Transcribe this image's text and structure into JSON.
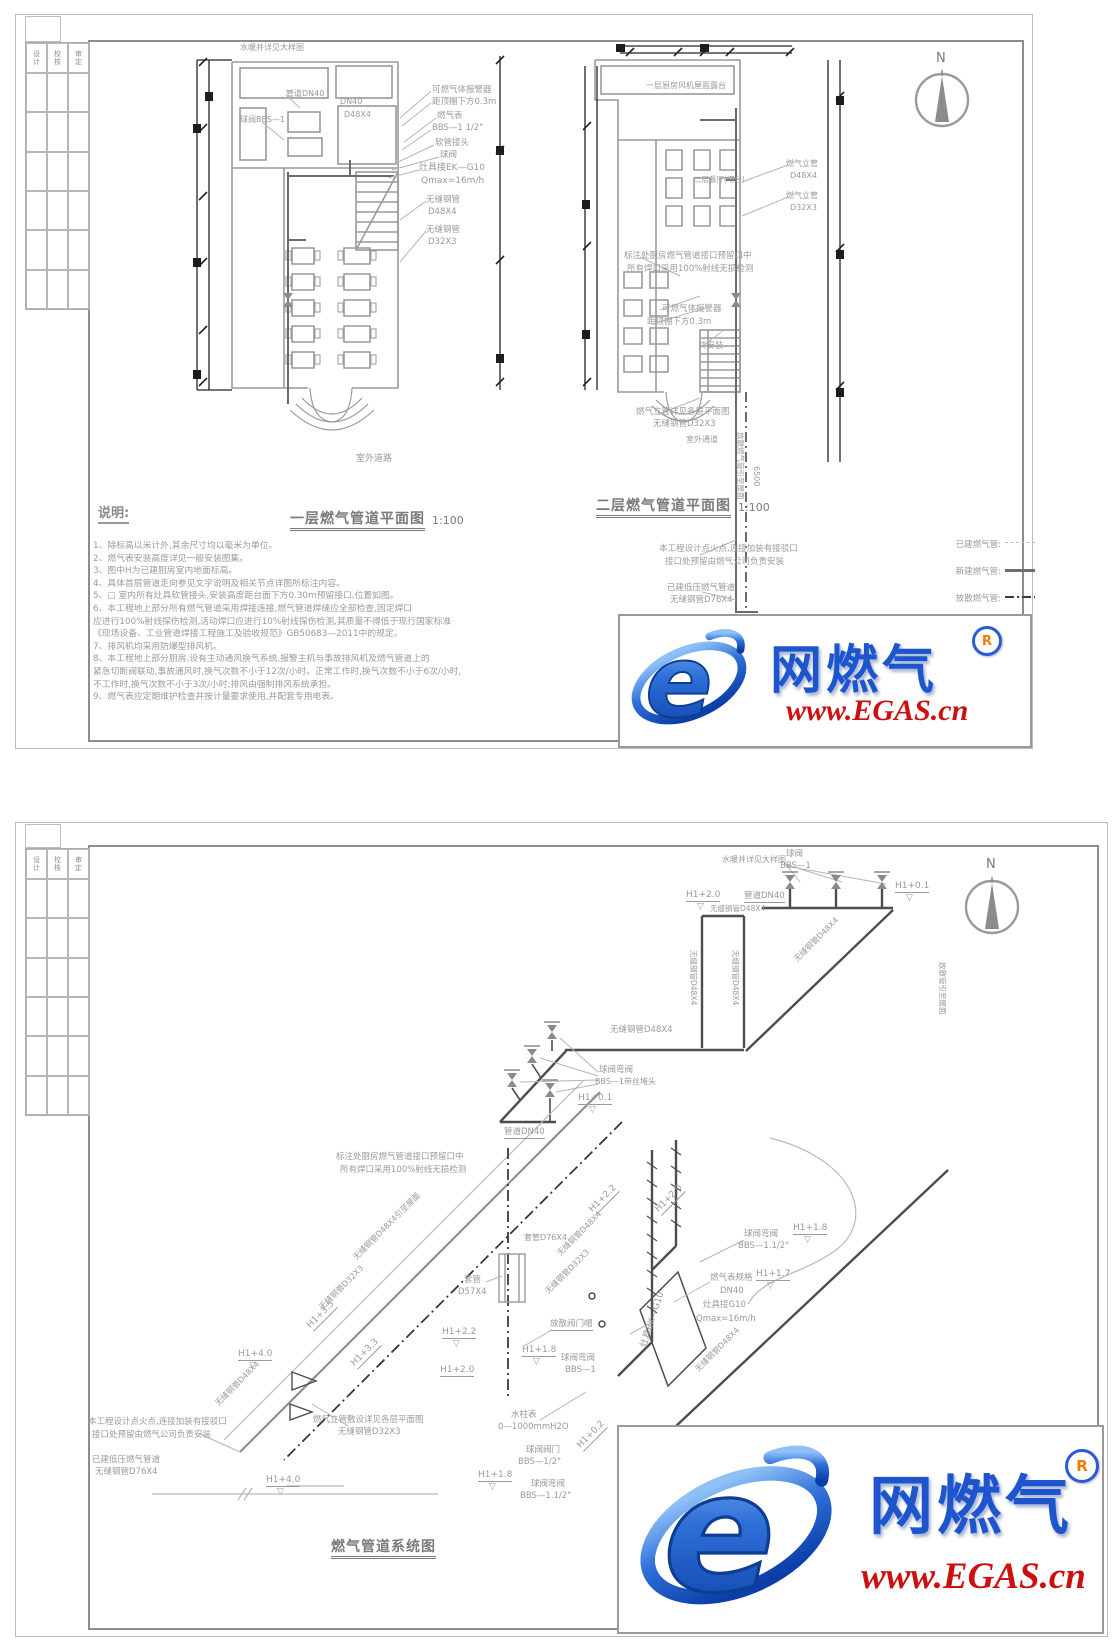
{
  "titleblock": {
    "headers": [
      "设计",
      "校核",
      "审定"
    ]
  },
  "watermark": {
    "brand": "网燃气",
    "reg": "R",
    "url": "www.EGAS.cn"
  },
  "sheet1": {
    "notes_heading": "说明:",
    "notes": [
      "1、除标高以米计外,其余尺寸均以毫米为单位。",
      "2、燃气表安装高度详见一般安装图集。",
      "3、图中H为已建厨房室内地面标高。",
      "4、具体首层管道走向参见文字说明及相关节点详图所标注内容。",
      "5、□  室内所有灶具软管接头,安装高度距台面下方0.30m预留接口,位置如图。",
      "6、本工程地上部分所有燃气管道采用焊接连接,燃气管道焊缝应全部检查,固定焊口",
      "应进行100%射线探伤检测,活动焊口应进行10%射线探伤检测,其质量不得低于现行国家标准",
      "《现场设备、工业管道焊接工程施工及验收规范》GB50683—2011中的规定。",
      "7、排风机均采用防爆型排风机。",
      "8、本工程地上部分厨房,设有主动通风换气系统,报警主机与事故排风机及燃气管道上的",
      "紧急切断阀联动,事故通风时,换气次数不小于12次/小时。正常工作时,换气次数不小于6次/小时,",
      "不工作时,换气次数不小于3次/小时;排风由强制排风系统承担。",
      "9、燃气表应定期维护检查并按计量要求使用,并配套专用电表。"
    ],
    "legend": [
      {
        "label": "已建燃气管:"
      },
      {
        "label": "新建燃气管:"
      },
      {
        "label": "放散燃气管:"
      }
    ]
  },
  "annotations": [
    {
      "t": "水暖井详见大样图",
      "x": 240,
      "y": 44,
      "fs": 8
    },
    {
      "t": "管道DN40",
      "x": 286,
      "y": 90,
      "fs": 8
    },
    {
      "t": "DN40",
      "x": 340,
      "y": 98,
      "fs": 8
    },
    {
      "t": "D48X4",
      "x": 344,
      "y": 111,
      "fs": 8
    },
    {
      "t": "球阀BBS—1",
      "x": 240,
      "y": 116,
      "fs": 8
    },
    {
      "t": "可燃气体报警器",
      "x": 432,
      "y": 86,
      "fs": 8.5
    },
    {
      "t": "距顶棚下方0.3m",
      "x": 432,
      "y": 98,
      "fs": 8.5
    },
    {
      "t": "燃气表",
      "x": 437,
      "y": 112,
      "fs": 8.5
    },
    {
      "t": "BBS—1 1/2\"",
      "x": 432,
      "y": 124,
      "fs": 8.5
    },
    {
      "t": "软管接头",
      "x": 435,
      "y": 139,
      "fs": 8.5
    },
    {
      "t": "球阀",
      "x": 440,
      "y": 151,
      "fs": 8.5
    },
    {
      "t": "灶具接EK—G10",
      "x": 419,
      "y": 164,
      "fs": 9
    },
    {
      "t": "Qmax=16m/h",
      "x": 421,
      "y": 177,
      "fs": 9
    },
    {
      "t": "无缝钢管",
      "x": 426,
      "y": 196,
      "fs": 8.5
    },
    {
      "t": "D48X4",
      "x": 428,
      "y": 208,
      "fs": 8.5
    },
    {
      "t": "无缝钢管",
      "x": 426,
      "y": 226,
      "fs": 8.5
    },
    {
      "t": "D32X3",
      "x": 428,
      "y": 238,
      "fs": 8.5
    },
    {
      "t": "室外道路",
      "x": 356,
      "y": 455,
      "fs": 9
    },
    {
      "t": "一层燃气管道平面图",
      "x": 290,
      "y": 512,
      "fs": 14,
      "c": "d",
      "b": 1,
      "u": 2,
      "n": "plan1-title"
    },
    {
      "t": "1:100",
      "x": 432,
      "y": 515,
      "fs": 11,
      "c": "d",
      "n": "plan1-scale"
    },
    {
      "t": "一层厨房风机屋面露台",
      "x": 646,
      "y": 82,
      "fs": 8
    },
    {
      "t": "二层餐厅(吧台)",
      "x": 694,
      "y": 176,
      "fs": 7.5
    },
    {
      "t": "燃气立管",
      "x": 786,
      "y": 160,
      "fs": 8
    },
    {
      "t": "D48X4",
      "x": 790,
      "y": 172,
      "fs": 8
    },
    {
      "t": "燃气立管",
      "x": 786,
      "y": 192,
      "fs": 8
    },
    {
      "t": "D32X3",
      "x": 790,
      "y": 204,
      "fs": 8
    },
    {
      "t": "标注处厨房燃气管道接口预留口中",
      "x": 624,
      "y": 252,
      "fs": 8.5
    },
    {
      "t": "所有焊口采用100%射线无损检测",
      "x": 627,
      "y": 265,
      "fs": 8.5
    },
    {
      "t": "可燃气体报警器",
      "x": 662,
      "y": 305,
      "fs": 8.5
    },
    {
      "t": "距顶棚下方0.3m",
      "x": 647,
      "y": 318,
      "fs": 8.5
    },
    {
      "t": "共安装",
      "x": 698,
      "y": 342,
      "fs": 8.5
    },
    {
      "t": "燃气立管详见各层平面图",
      "x": 636,
      "y": 408,
      "fs": 8.5
    },
    {
      "t": "无缝钢管D32X3",
      "x": 653,
      "y": 420,
      "fs": 8.5
    },
    {
      "t": "室外通道",
      "x": 686,
      "y": 436,
      "fs": 8
    },
    {
      "t": "放散燃气管引至屋面",
      "x": 744,
      "y": 432,
      "fs": 7.5,
      "rot": 90
    },
    {
      "t": "6500",
      "x": 760,
      "y": 466,
      "fs": 8,
      "rot": 90
    },
    {
      "t": "二层燃气管道平面图",
      "x": 596,
      "y": 499,
      "fs": 14,
      "c": "d",
      "b": 1,
      "u": 2,
      "n": "plan2-title"
    },
    {
      "t": "1:100",
      "x": 738,
      "y": 502,
      "fs": 11,
      "c": "d",
      "n": "plan2-scale"
    },
    {
      "t": "本工程设计点火点,连接加装有接驳口",
      "x": 659,
      "y": 545,
      "fs": 8.5
    },
    {
      "t": "接口处预留由燃气公司负责安装",
      "x": 665,
      "y": 558,
      "fs": 8.5
    },
    {
      "t": "已建低压燃气管道",
      "x": 667,
      "y": 584,
      "fs": 8.5
    },
    {
      "t": "无缝钢管D76X4",
      "x": 670,
      "y": 596,
      "fs": 8.5
    },
    {
      "t": "N",
      "x": 936,
      "y": 52,
      "fs": 13,
      "c": "d",
      "n": "north-label"
    },
    {
      "t": "水暖井详见大样图",
      "x": 722,
      "y": 856,
      "fs": 8
    },
    {
      "t": "球阀",
      "x": 786,
      "y": 850,
      "fs": 8.5
    },
    {
      "t": "BBS—1",
      "x": 780,
      "y": 862,
      "fs": 8.5
    },
    {
      "t": "管道DN40",
      "x": 744,
      "y": 892,
      "fs": 8.5,
      "u": 1
    },
    {
      "t": "H1+2.0",
      "x": 686,
      "y": 891,
      "fs": 9,
      "u": 1
    },
    {
      "t": "▽",
      "x": 697,
      "y": 903,
      "fs": 9
    },
    {
      "t": "H1+0.1",
      "x": 895,
      "y": 882,
      "fs": 9,
      "u": 1
    },
    {
      "t": "▽",
      "x": 906,
      "y": 894,
      "fs": 9
    },
    {
      "t": "无缝钢管D48X4",
      "x": 710,
      "y": 905,
      "fs": 7.5
    },
    {
      "t": "无缝钢管D48X4",
      "x": 697,
      "y": 950,
      "fs": 7.5,
      "rot": 90
    },
    {
      "t": "无缝钢管D48X4",
      "x": 739,
      "y": 950,
      "fs": 7.5,
      "rot": 90
    },
    {
      "t": "无缝钢管D48X4",
      "x": 793,
      "y": 958,
      "fs": 8,
      "rot": -45
    },
    {
      "t": "放散管引至屋面",
      "x": 946,
      "y": 962,
      "fs": 7.5,
      "rot": 90
    },
    {
      "t": "无缝钢管D48X4",
      "x": 610,
      "y": 1026,
      "fs": 8.5
    },
    {
      "t": "球阀弯阀",
      "x": 599,
      "y": 1066,
      "fs": 8.5
    },
    {
      "t": "BBS—1带丝堵头",
      "x": 595,
      "y": 1078,
      "fs": 8
    },
    {
      "t": "H1+0.1",
      "x": 578,
      "y": 1094,
      "fs": 9,
      "u": 1
    },
    {
      "t": "▽",
      "x": 589,
      "y": 1106,
      "fs": 9
    },
    {
      "t": "管道DN40",
      "x": 504,
      "y": 1128,
      "fs": 8.5,
      "u": 1
    },
    {
      "t": "标注处厨房燃气管道接口预留口中",
      "x": 336,
      "y": 1153,
      "fs": 8.5
    },
    {
      "t": "所有焊口采用100%射线无损检测",
      "x": 340,
      "y": 1166,
      "fs": 8.5
    },
    {
      "t": "H1+2.2",
      "x": 588,
      "y": 1208,
      "fs": 9,
      "rot": -45,
      "u": 1
    },
    {
      "t": "H1+2.0",
      "x": 654,
      "y": 1208,
      "fs": 9,
      "rot": -45,
      "u": 1
    },
    {
      "t": "套管D76X4",
      "x": 524,
      "y": 1234,
      "fs": 8
    },
    {
      "t": "无缝钢管D48X4",
      "x": 556,
      "y": 1252,
      "fs": 8,
      "rot": -45
    },
    {
      "t": "无缝钢管D32X3",
      "x": 544,
      "y": 1290,
      "fs": 8,
      "rot": -45
    },
    {
      "t": "无缝钢管D48X4引至屋面",
      "x": 352,
      "y": 1256,
      "fs": 8,
      "rot": -45
    },
    {
      "t": "无缝钢管D32X3",
      "x": 318,
      "y": 1306,
      "fs": 8,
      "rot": -45
    },
    {
      "t": "套管",
      "x": 464,
      "y": 1276,
      "fs": 8.5
    },
    {
      "t": "D57X4",
      "x": 458,
      "y": 1288,
      "fs": 8.5
    },
    {
      "t": "H1+3.5",
      "x": 306,
      "y": 1324,
      "fs": 9,
      "rot": -45,
      "u": 1
    },
    {
      "t": "H1+3.3",
      "x": 350,
      "y": 1362,
      "fs": 9,
      "rot": -45,
      "u": 1
    },
    {
      "t": "H1+4.0",
      "x": 238,
      "y": 1350,
      "fs": 9,
      "u": 1
    },
    {
      "t": "▽",
      "x": 249,
      "y": 1362,
      "fs": 9
    },
    {
      "t": "H1+2.2",
      "x": 442,
      "y": 1328,
      "fs": 9,
      "u": 1
    },
    {
      "t": "▽",
      "x": 453,
      "y": 1340,
      "fs": 9
    },
    {
      "t": "H1+2.0",
      "x": 440,
      "y": 1366,
      "fs": 9,
      "u": 1
    },
    {
      "t": "放散阀门帽",
      "x": 550,
      "y": 1320,
      "fs": 8.5,
      "u": 1
    },
    {
      "t": "H1+1.8",
      "x": 522,
      "y": 1346,
      "fs": 9,
      "u": 1
    },
    {
      "t": "▽",
      "x": 533,
      "y": 1358,
      "fs": 9
    },
    {
      "t": "球阀弯阀",
      "x": 561,
      "y": 1354,
      "fs": 8.5
    },
    {
      "t": "BBS—1",
      "x": 565,
      "y": 1366,
      "fs": 8.5
    },
    {
      "t": "水柱表",
      "x": 511,
      "y": 1411,
      "fs": 8.5
    },
    {
      "t": "0—1000mmH2O",
      "x": 498,
      "y": 1423,
      "fs": 8.5
    },
    {
      "t": "球阀弯阀",
      "x": 744,
      "y": 1230,
      "fs": 8.5
    },
    {
      "t": "BBS—1.1/2\"",
      "x": 738,
      "y": 1242,
      "fs": 8.5
    },
    {
      "t": "H1+1.8",
      "x": 793,
      "y": 1224,
      "fs": 9,
      "u": 1
    },
    {
      "t": "▽",
      "x": 804,
      "y": 1236,
      "fs": 9
    },
    {
      "t": "燃气表规格",
      "x": 710,
      "y": 1274,
      "fs": 8.5
    },
    {
      "t": "H1+1.7",
      "x": 756,
      "y": 1270,
      "fs": 9,
      "u": 1
    },
    {
      "t": "▽",
      "x": 767,
      "y": 1282,
      "fs": 9
    },
    {
      "t": "DN40",
      "x": 720,
      "y": 1287,
      "fs": 8.5
    },
    {
      "t": "灶具接G10",
      "x": 703,
      "y": 1301,
      "fs": 8.5
    },
    {
      "t": "Qmax=16m/h",
      "x": 696,
      "y": 1315,
      "fs": 8.5
    },
    {
      "t": "无缝钢管D48X4",
      "x": 694,
      "y": 1368,
      "fs": 8,
      "rot": -45
    },
    {
      "t": "灶具BX—G10",
      "x": 640,
      "y": 1346,
      "fs": 9,
      "rot": -72
    },
    {
      "t": "H1+0.2",
      "x": 576,
      "y": 1444,
      "fs": 9,
      "rot": -45,
      "u": 1
    },
    {
      "t": "球阀阀门",
      "x": 526,
      "y": 1446,
      "fs": 8.5
    },
    {
      "t": "BBS—1/2\"",
      "x": 518,
      "y": 1458,
      "fs": 8.5
    },
    {
      "t": "H1+1.8",
      "x": 478,
      "y": 1471,
      "fs": 9,
      "u": 1
    },
    {
      "t": "▽",
      "x": 489,
      "y": 1483,
      "fs": 9
    },
    {
      "t": "球阀弯阀",
      "x": 531,
      "y": 1480,
      "fs": 8.5
    },
    {
      "t": "BBS—1.1/2\"",
      "x": 520,
      "y": 1492,
      "fs": 8.5
    },
    {
      "t": "H1+4.0",
      "x": 266,
      "y": 1476,
      "fs": 9,
      "u": 1
    },
    {
      "t": "▽",
      "x": 277,
      "y": 1488,
      "fs": 9
    },
    {
      "t": "本工程设计点火点,连接加装有接驳口",
      "x": 88,
      "y": 1418,
      "fs": 8.5
    },
    {
      "t": "接口处预留由燃气公司负责安装",
      "x": 92,
      "y": 1431,
      "fs": 8.5
    },
    {
      "t": "已建低压燃气管道",
      "x": 92,
      "y": 1456,
      "fs": 8.5
    },
    {
      "t": "无缝钢管D76X4",
      "x": 95,
      "y": 1468,
      "fs": 8.5
    },
    {
      "t": "燃气立管敷设详见各层平面图",
      "x": 313,
      "y": 1416,
      "fs": 8.5
    },
    {
      "t": "无缝钢管D32X3",
      "x": 338,
      "y": 1428,
      "fs": 8.5
    },
    {
      "t": "无缝钢管D48X4",
      "x": 214,
      "y": 1402,
      "fs": 8,
      "rot": -45
    },
    {
      "t": "燃气管道系统图",
      "x": 331,
      "y": 1540,
      "fs": 14,
      "c": "d",
      "b": 1,
      "u": 2,
      "n": "system-diagram-title"
    },
    {
      "t": "N",
      "x": 986,
      "y": 858,
      "fs": 13,
      "c": "d",
      "n": "north-label"
    }
  ]
}
